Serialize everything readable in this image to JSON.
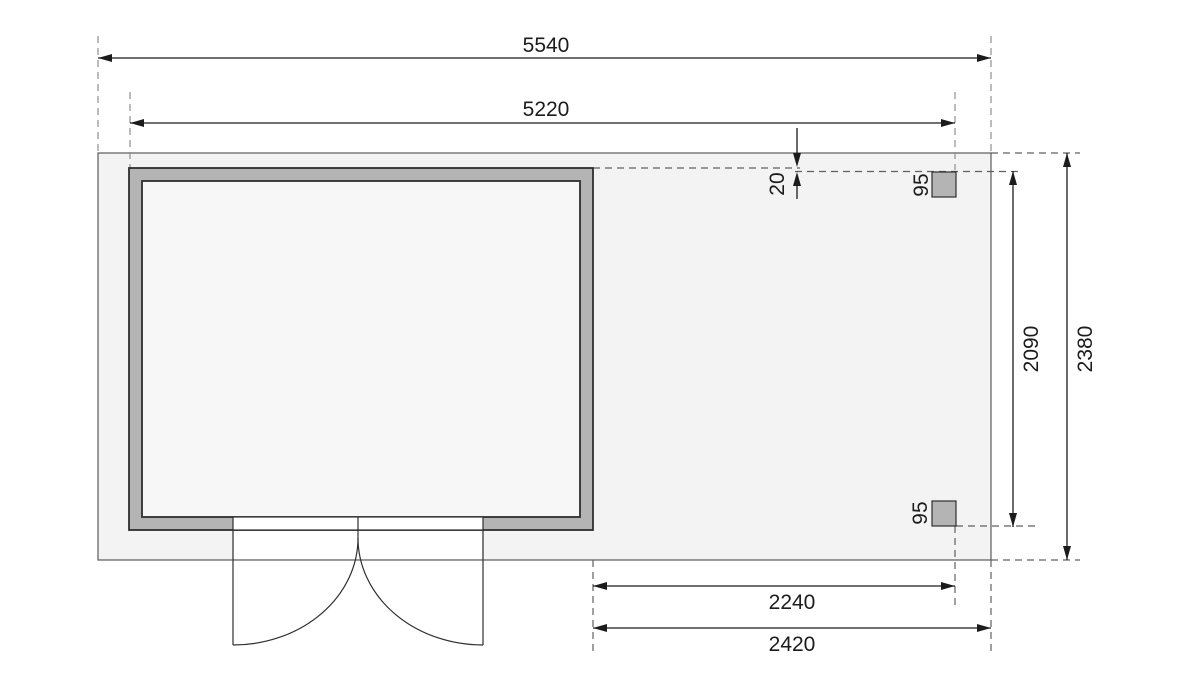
{
  "drawing": {
    "dims": {
      "total_width": "5540",
      "cabin_width": "5220",
      "front_offset": "20",
      "post_width_top": "95",
      "post_width_bottom": "95",
      "annex_post_depth": "2090",
      "total_depth": "2380",
      "annex_clear_width": "2240",
      "annex_width": "2420"
    },
    "colors": {
      "plot_fill": "#f3f3f3",
      "interior_fill": "#f7f7f7",
      "wall_fill": "#b4b4b4",
      "post_fill": "#b4b4b4",
      "door_fill": "#ffffff",
      "line": "#1c1c1c"
    }
  }
}
